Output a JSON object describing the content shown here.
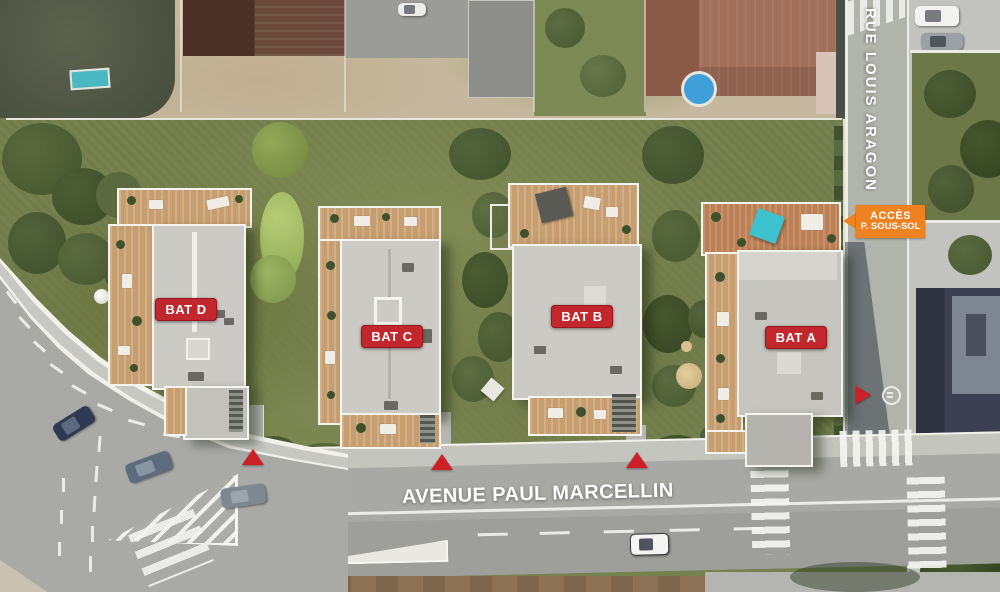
{
  "streets": {
    "rue": "RUE LOUIS ARAGON",
    "avenue": "AVENUE PAUL MARCELLIN"
  },
  "buildings": [
    {
      "id": "bat-a",
      "label": "BAT A"
    },
    {
      "id": "bat-b",
      "label": "BAT B"
    },
    {
      "id": "bat-c",
      "label": "BAT C"
    },
    {
      "id": "bat-d",
      "label": "BAT D"
    }
  ],
  "access_label": {
    "line1": "ACCÈS",
    "line2": "P. SOUS-SOL"
  },
  "markers": {
    "entrance_triangles": 4,
    "triangle_color": "#cc2027"
  },
  "colors": {
    "building_label_bg": "#c1272d",
    "access_label_bg": "#ef8220",
    "label_text": "#ffffff",
    "garden_green": "#76814f",
    "road_grey": "#a8a8a5"
  }
}
